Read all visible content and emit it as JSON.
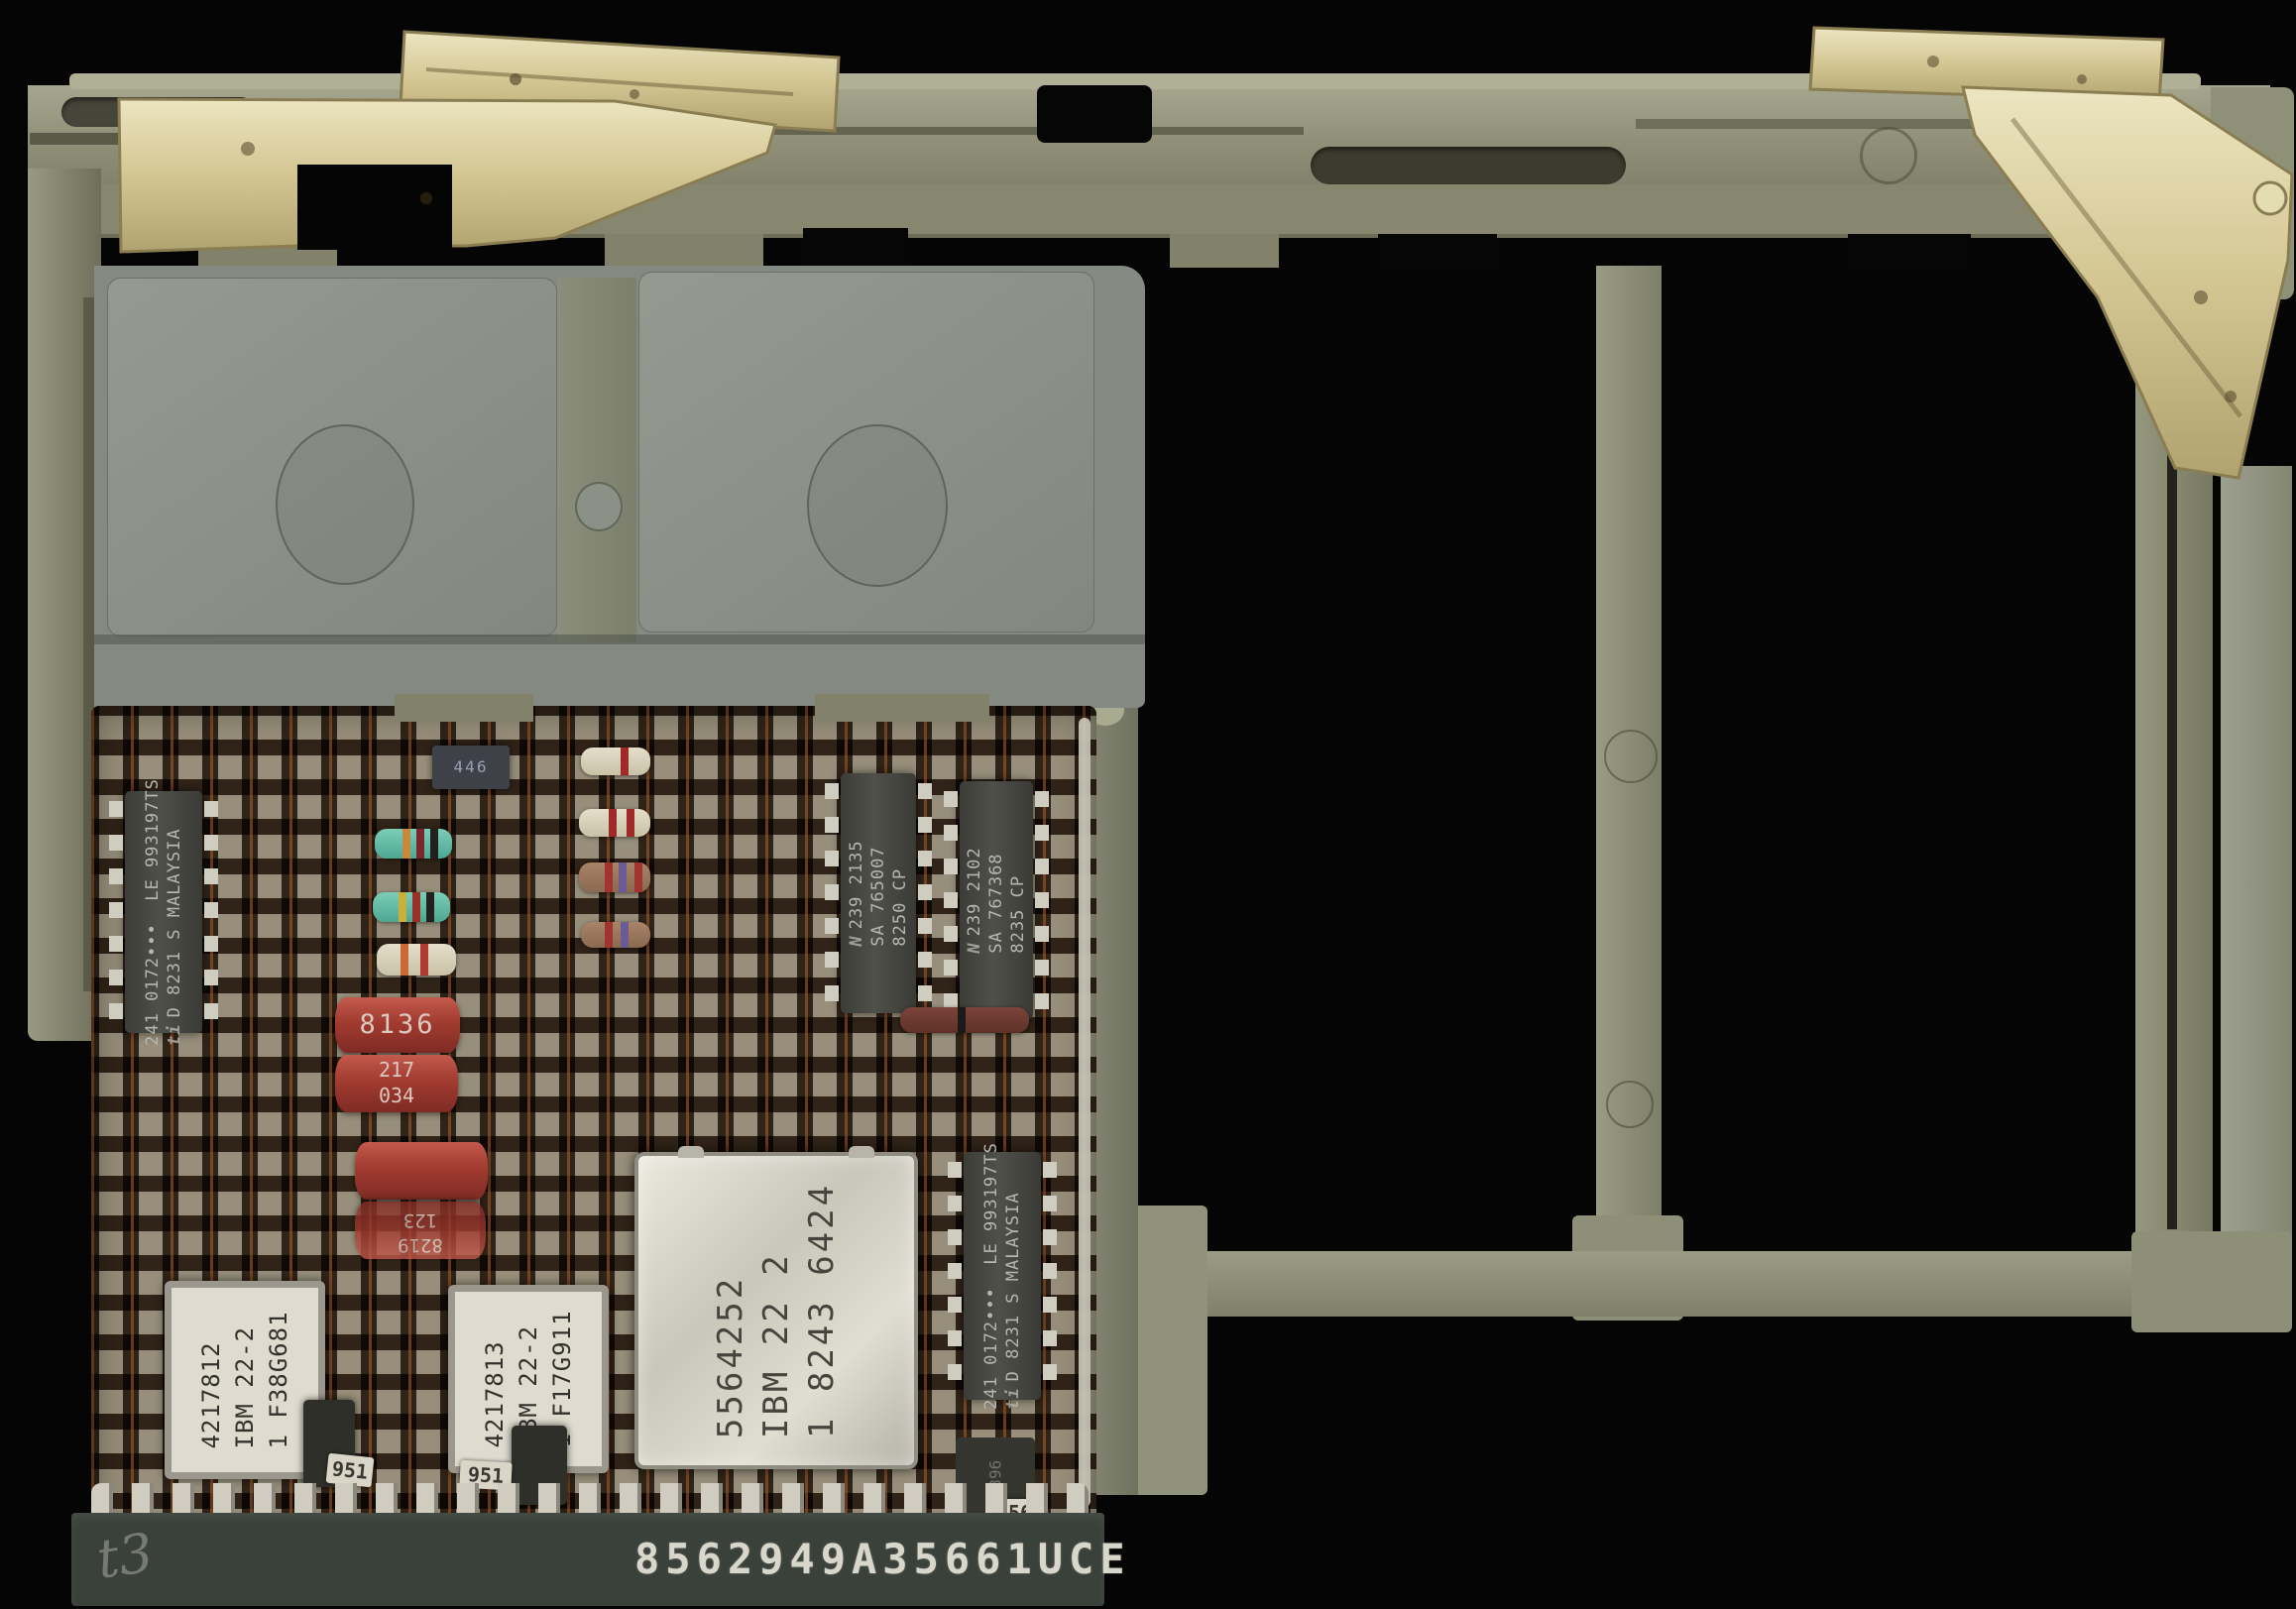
{
  "scene": {
    "description": "IBM circuit card module mounted in an olive plastic carrier frame with two brass retention clips, photographed on a black background",
    "connector_stamp": "8562949A35661UCE",
    "handwritten_mark": "t3"
  },
  "colors": {
    "background": "#050505",
    "frame_olive": "#8f8f77",
    "brass": "#d6cb96",
    "plate_grey": "#8b9189",
    "pcb_brown": "#5a4330",
    "solder_pad": "#c4bfb1",
    "capacitor_red": "#a23b30",
    "can_silver": "#d8d5ca"
  },
  "components": {
    "ti_left": {
      "logo": "ti",
      "l1": "241 0172•••",
      "l2": "LE 993197TS",
      "l3": "D 8231 S MALAYSIA"
    },
    "ti_right": {
      "logo": "ti",
      "l1": "241 0172•••",
      "l2": "LE 993197TS",
      "l3": "D 8231 S MALAYSIA"
    },
    "ns1": {
      "logo": "N",
      "l1": "239 2135",
      "l2": "SA 765007",
      "l3": "8250 CP"
    },
    "ns2": {
      "logo": "N",
      "l1": "239 2102",
      "l2": "SA 767368",
      "l3": "8235 CP"
    },
    "can": {
      "l1": "5564252",
      "l2": "IBM 22 2",
      "l3": "1 8243 6424"
    },
    "module1": {
      "l1": "4217812",
      "l2": "IBM 22-2",
      "l3": "1 F38G681"
    },
    "module2": {
      "l1": "4217813",
      "l2": "IBM 22-2",
      "l3": "1 F17G911"
    },
    "cap1_top": "8136",
    "cap1_mid": "217",
    "cap1_bot": "034",
    "cap2_a": "8219",
    "cap2_b": "123",
    "chip446": "446",
    "chip_bottom_right": "2396",
    "label_a": "951",
    "label_b": "951",
    "label_c": "156"
  }
}
